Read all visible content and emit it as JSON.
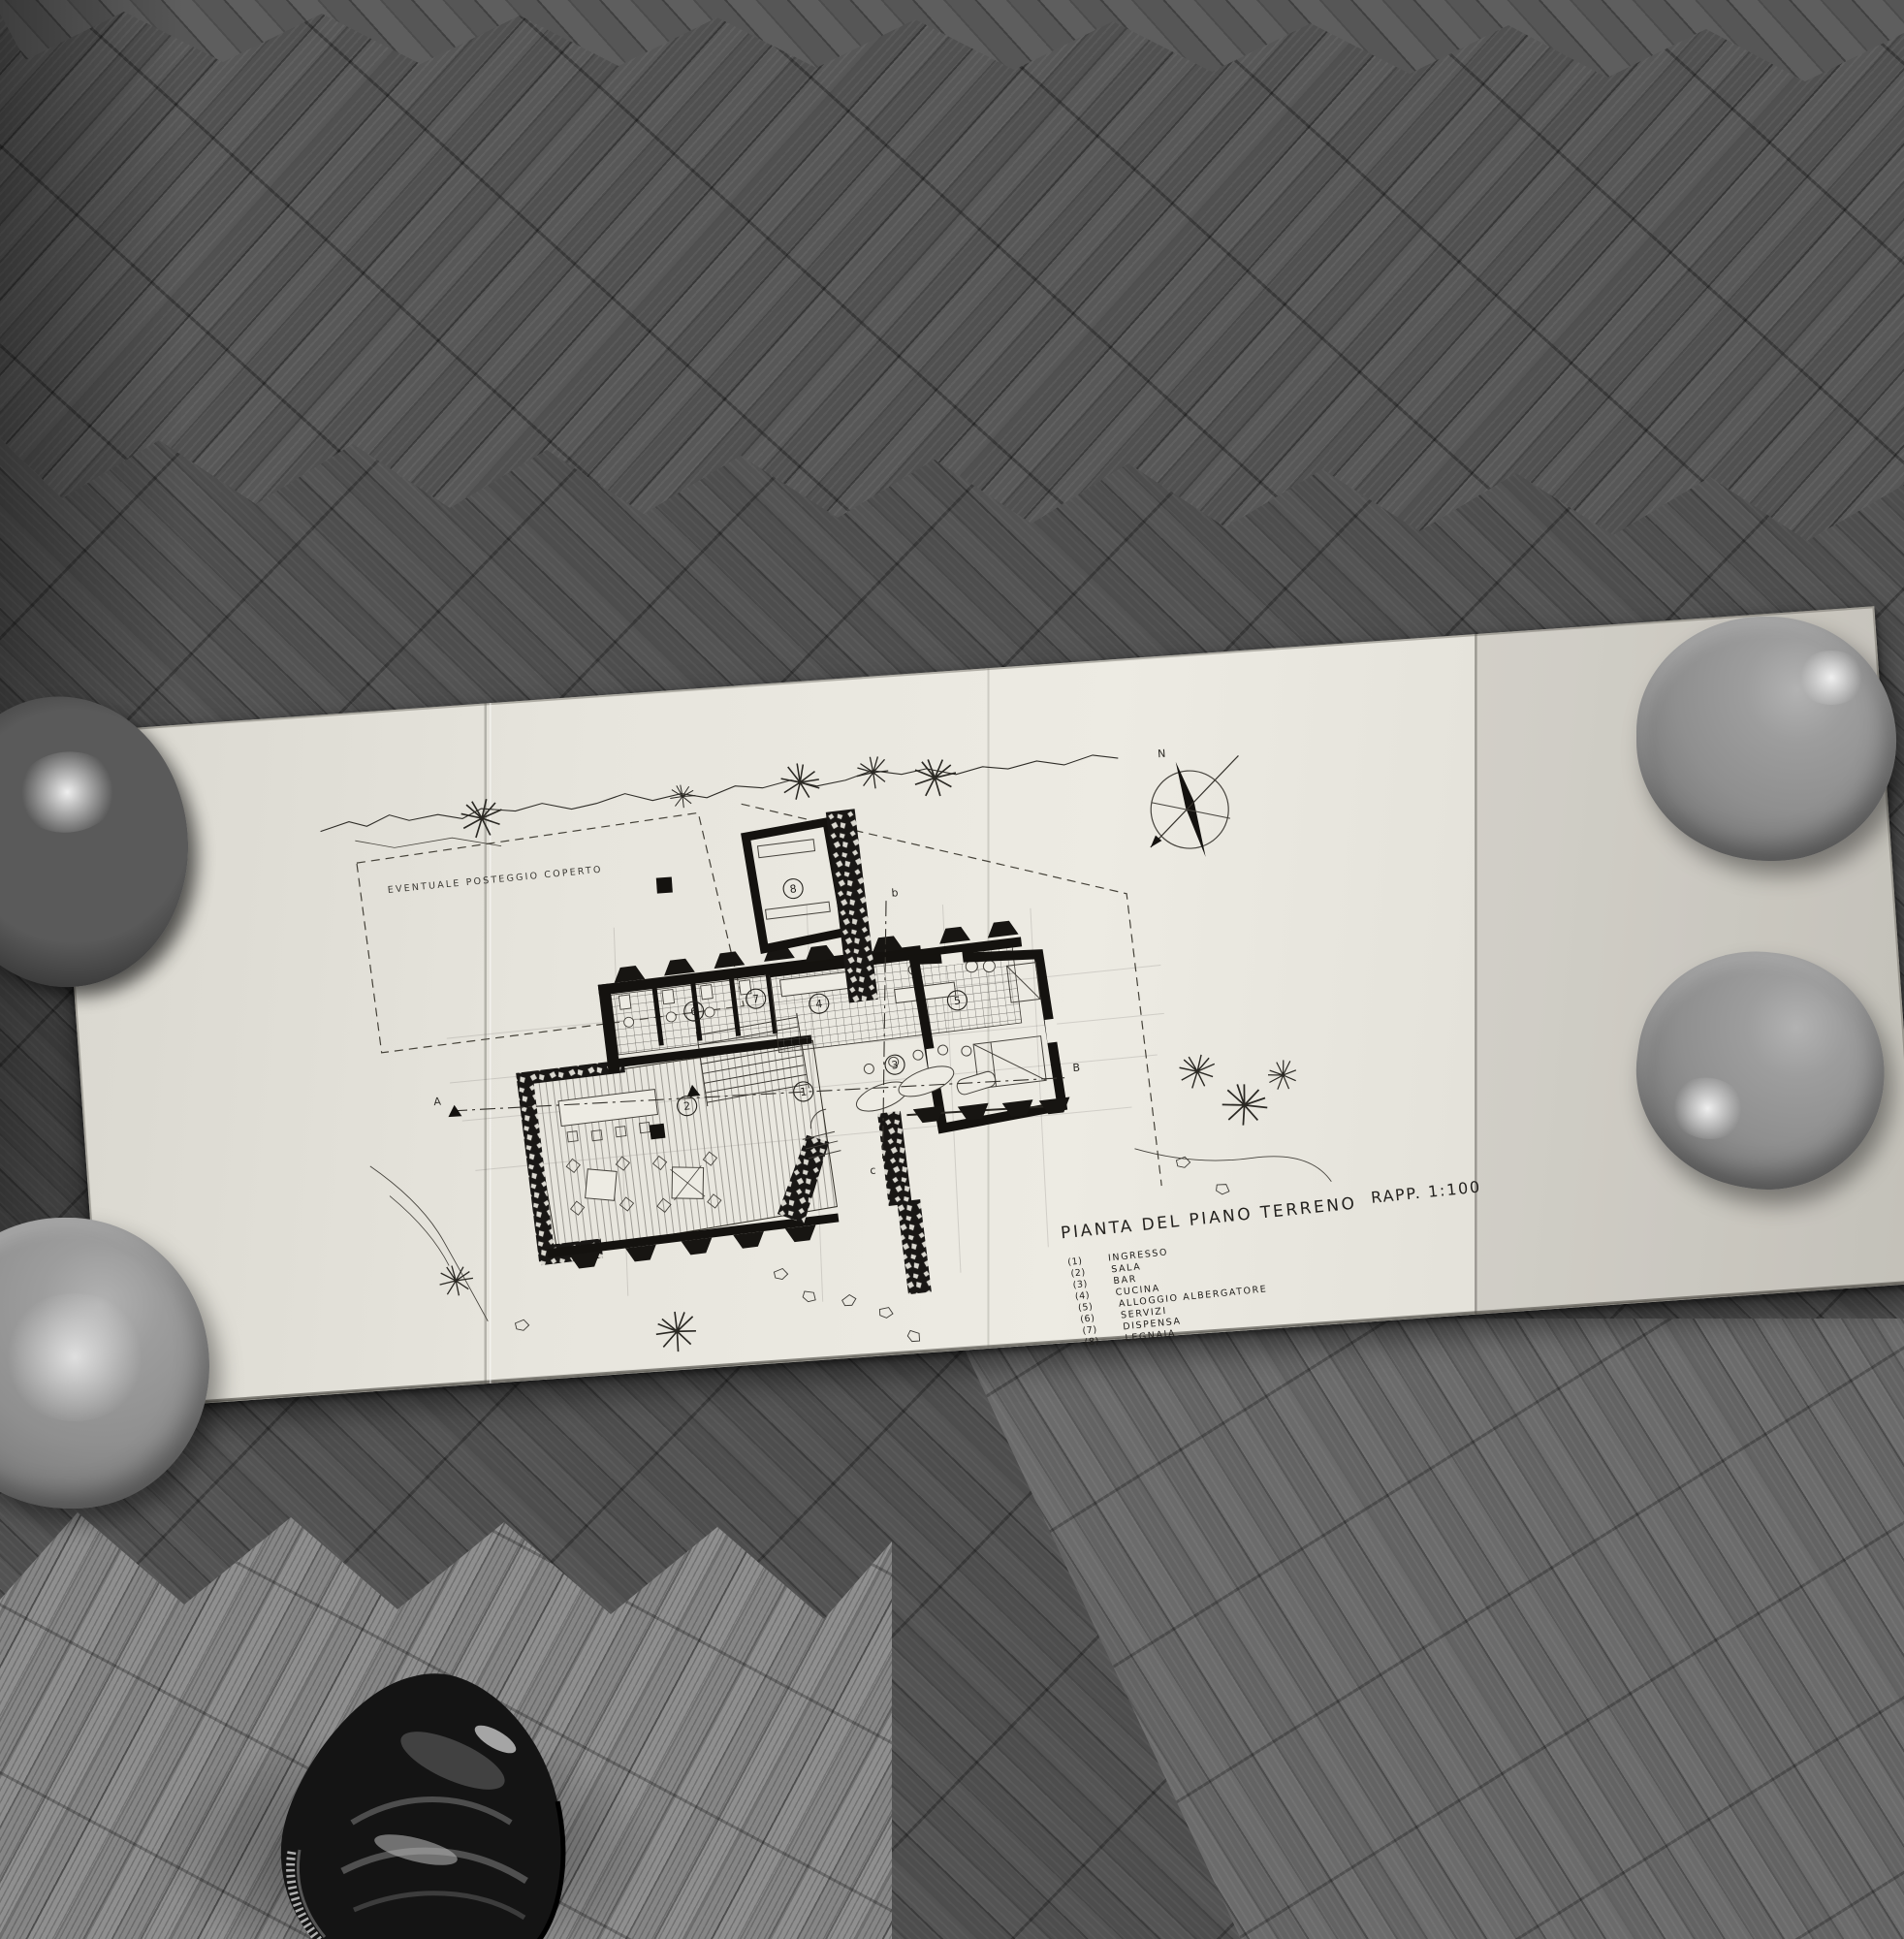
{
  "drawing": {
    "title": "PIANTA DEL PIANO TERRENO",
    "scale_label": "RAPP. 1:100",
    "annotation": "EVENTUALE POSTEGGIO COPERTO",
    "compass_label": "N",
    "section_labels": {
      "left": "A",
      "right": "B",
      "top": "b",
      "bottom": "c"
    },
    "room_numbers": [
      "1",
      "2",
      "3",
      "4",
      "5",
      "6",
      "7",
      "8"
    ],
    "legend": [
      {
        "num": "(1)",
        "label": "INGRESSO"
      },
      {
        "num": "(2)",
        "label": "SALA"
      },
      {
        "num": "(3)",
        "label": "BAR"
      },
      {
        "num": "(4)",
        "label": "CUCINA"
      },
      {
        "num": "(5)",
        "label": "ALLOGGIO ALBERGATORE"
      },
      {
        "num": "(6)",
        "label": "SERVIZI"
      },
      {
        "num": "(7)",
        "label": "DISPENSA"
      },
      {
        "num": "(8)",
        "label": "LEGNAIA"
      }
    ]
  },
  "colors": {
    "paper": "#e7e5dd",
    "ink": "#1c1a17",
    "floor_dark": "#3b3b3b",
    "floor_mid": "#535353",
    "floor_light": "#8f8f8f",
    "bowl": "#8f8f8f",
    "shoe": "#141414"
  }
}
